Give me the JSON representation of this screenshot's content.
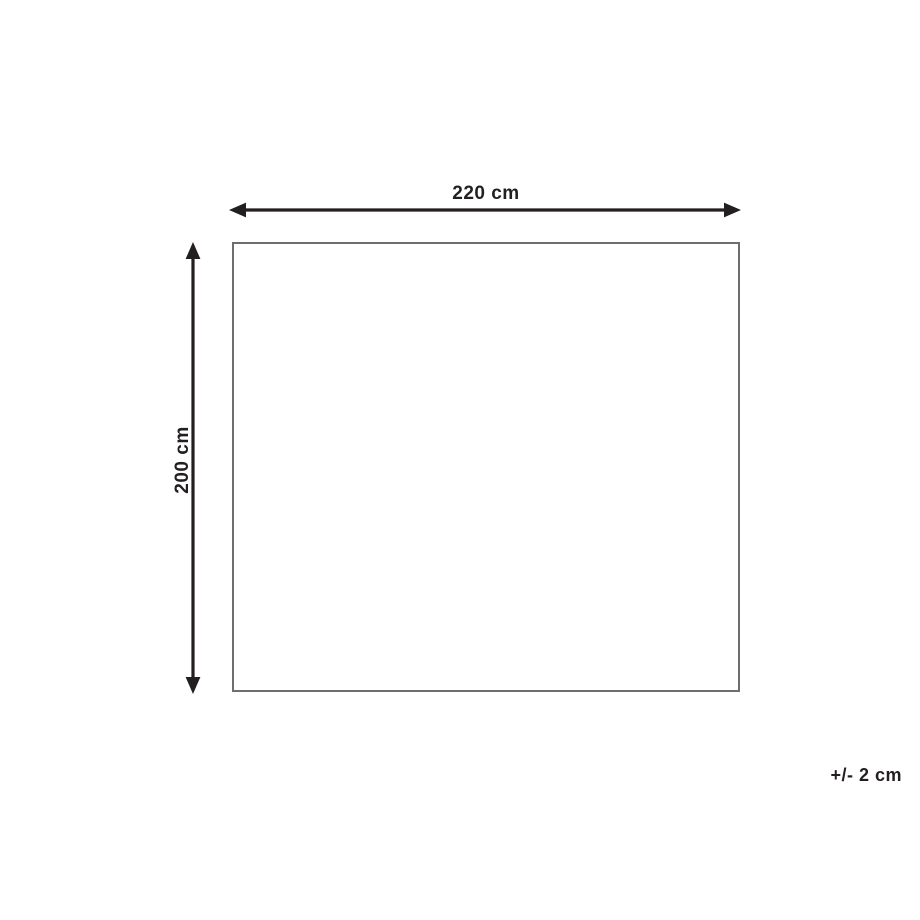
{
  "diagram": {
    "type": "product-dimensions",
    "width_dimension": {
      "label": "220 cm",
      "value_cm": 220,
      "orientation": "horizontal"
    },
    "height_dimension": {
      "label": "200 cm",
      "value_cm": 200,
      "orientation": "vertical"
    },
    "tolerance": {
      "label": "+/- 2 cm",
      "value_cm": 2
    },
    "colors": {
      "background": "#ffffff",
      "arrow": "#231f20",
      "text": "#231f20",
      "rect_border": "#6d6e70"
    }
  }
}
